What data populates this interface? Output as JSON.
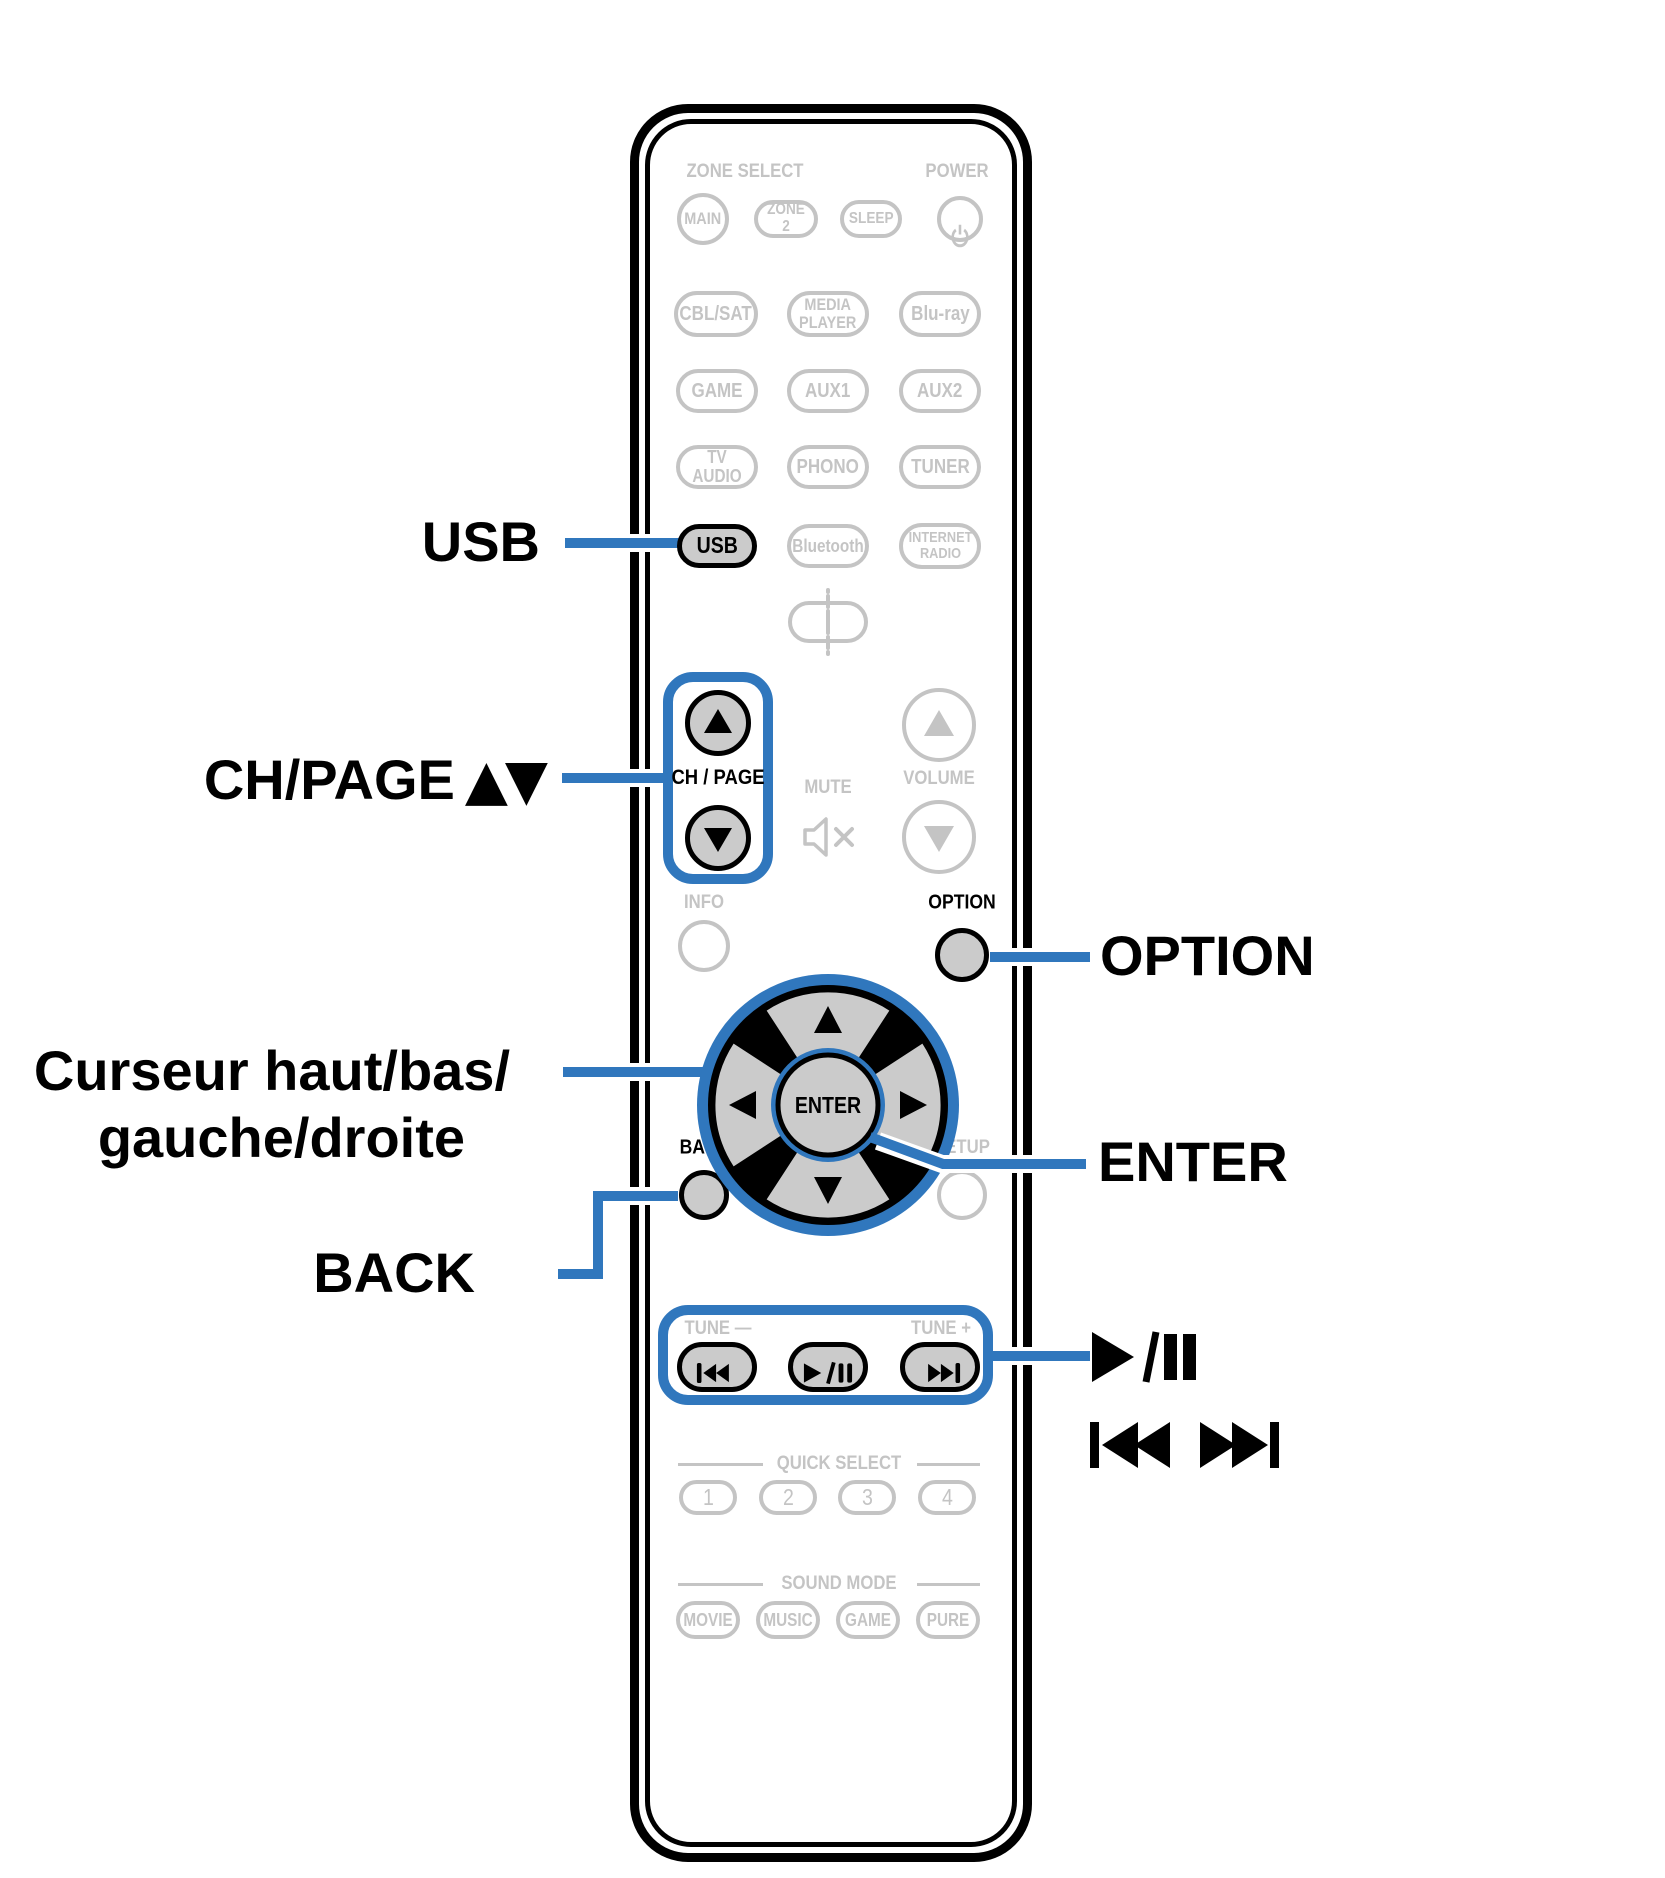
{
  "colors": {
    "accent_blue": "#3077bd",
    "printed_gray": "#c4c4c4",
    "highlight_fill": "#cbcbcb",
    "ink_black": "#000000"
  },
  "remote": {
    "sections": {
      "zone_select": "ZONE SELECT",
      "power": "POWER",
      "ch_page": "CH / PAGE",
      "mute": "MUTE",
      "volume": "VOLUME",
      "info": "INFO",
      "option": "OPTION",
      "back": "BACK",
      "setup": "SETUP",
      "enter": "ENTER",
      "tune_minus": "TUNE —",
      "tune_plus": "TUNE +",
      "quick_select": "QUICK SELECT",
      "sound_mode": "SOUND MODE"
    },
    "buttons": {
      "zone": [
        "MAIN",
        "ZONE 2",
        "SLEEP"
      ],
      "row1": [
        "CBL/SAT",
        "MEDIA\nPLAYER",
        "Blu-ray"
      ],
      "row2": [
        "GAME",
        "AUX1",
        "AUX2"
      ],
      "row3": [
        "TV AUDIO",
        "PHONO",
        "TUNER"
      ],
      "row4": [
        "USB",
        "Bluetooth",
        "INTERNET\nRADIO"
      ],
      "quick": [
        "1",
        "2",
        "3",
        "4"
      ],
      "sound": [
        "MOVIE",
        "MUSIC",
        "GAME",
        "PURE"
      ]
    },
    "icons": {
      "power": "power-icon",
      "mute": "speaker-mute-icon",
      "sound_wave": "sound-wave-icon",
      "ch_up": "arrow-up-icon",
      "ch_down": "arrow-down-icon",
      "volume_up": "arrow-up-icon",
      "volume_down": "arrow-down-icon",
      "cursor": "cursor-pad-icon",
      "skip_back": "skip-back-icon",
      "play_pause": "play-pause-icon",
      "skip_forward": "skip-forward-icon"
    }
  },
  "callouts": {
    "usb": "USB",
    "ch_page": "CH/PAGE",
    "ch_page_arrows": "▲▼",
    "cursor_line1": "Curseur haut/bas/",
    "cursor_line2": "gauche/droite",
    "option": "OPTION",
    "enter": "ENTER",
    "back": "BACK",
    "play_pause_icon": "play-pause-icon",
    "skip_icon": "skip-back-forward-icon"
  }
}
